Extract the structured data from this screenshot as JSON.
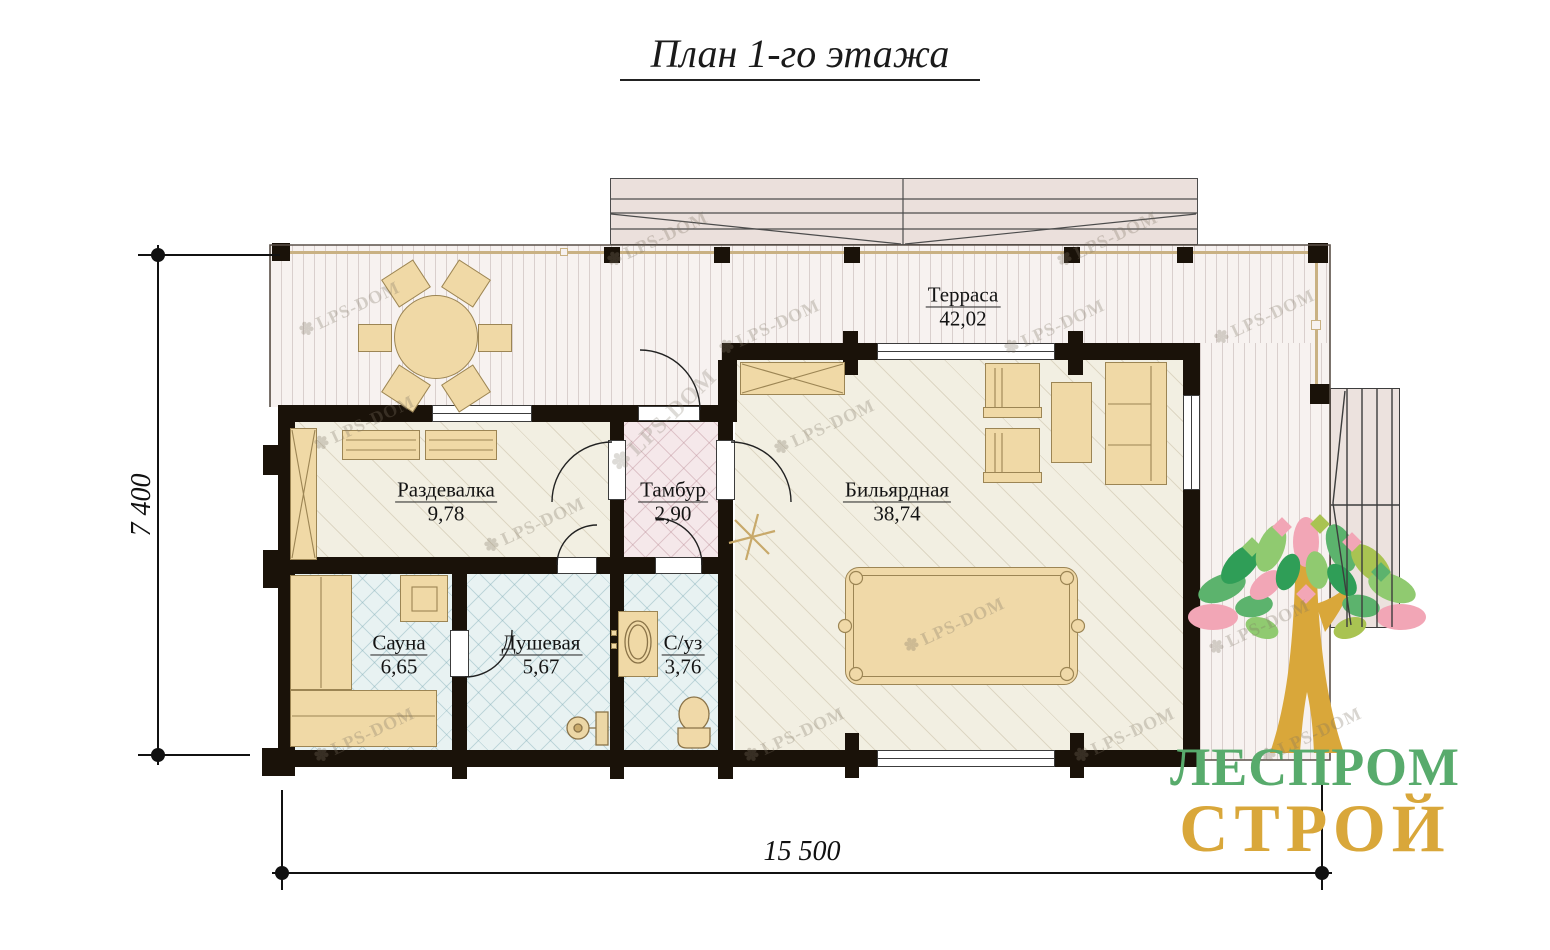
{
  "title": "План 1-го этажа",
  "rooms": [
    {
      "name": "Терраса",
      "area": "42,02"
    },
    {
      "name": "Раздевалка",
      "area": "9,78"
    },
    {
      "name": "Тамбур",
      "area": "2,90"
    },
    {
      "name": "Бильярдная",
      "area": "38,74"
    },
    {
      "name": "Сауна",
      "area": "6,65"
    },
    {
      "name": "Душевая",
      "area": "5,67"
    },
    {
      "name": "С/уз",
      "area": "3,76"
    }
  ],
  "dimensions": {
    "horizontal": "15 500",
    "vertical": "7 400"
  },
  "watermark": "LPS-DOM",
  "icons": {
    "watermark_tree": "✽"
  },
  "logo": {
    "top": "ЛЕСПРОМ",
    "bottom": "СТРОЙ",
    "green": "#58ab6c",
    "gold": "#d9a73a"
  },
  "palette": {
    "wall": "#1a1209",
    "furniture": "#f0d9a6",
    "terrace_floor": "#f7f2f0",
    "wood_floor": "#f2efe2",
    "wet_floor": "#e8f2f2",
    "vestibule_floor": "#f5e8ea",
    "roof": "#ebe0dc"
  }
}
